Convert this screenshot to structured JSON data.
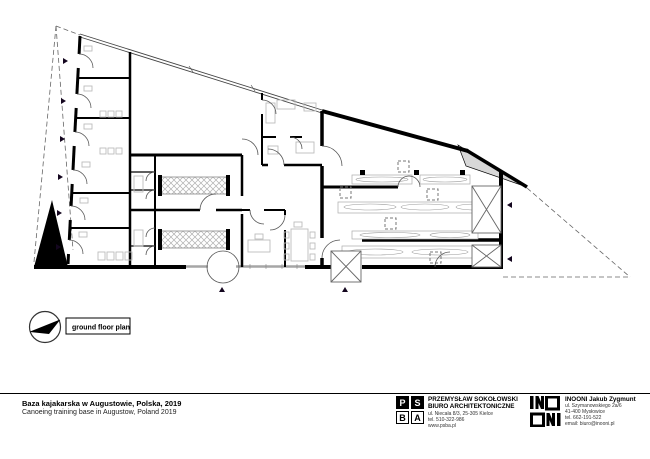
{
  "plan": {
    "label": "ground floor plan",
    "colors": {
      "wall": "#000000",
      "glazing": "#a6a6a6",
      "furniture": "#bdbdbd",
      "dashed_boundary": "#666666"
    }
  },
  "footer": {
    "project_title_pl": "Baza kajakarska w Augustowie, Polska, 2019",
    "project_title_en": "Canoeing training base in Augustow, Poland 2019",
    "psba": {
      "letters": [
        "P",
        "S",
        "B",
        "A"
      ],
      "name_line1": "PRZEMYSŁAW SOKOŁOWSKI",
      "name_line2": "BIURO ARCHITEKTONICZNE",
      "lines": [
        "ul. Niecała 8/3, 25-305 Kielce",
        "tel. 510-322-986",
        "www.psba.pl"
      ]
    },
    "inooni": {
      "name": "INOONI Jakub Zygmunt",
      "lines": [
        "ul. Szymanowskiego 2a/6",
        "41-400 Mysłowice",
        "tel. 662-191-522",
        "email: biuro@inooni.pl"
      ]
    }
  }
}
